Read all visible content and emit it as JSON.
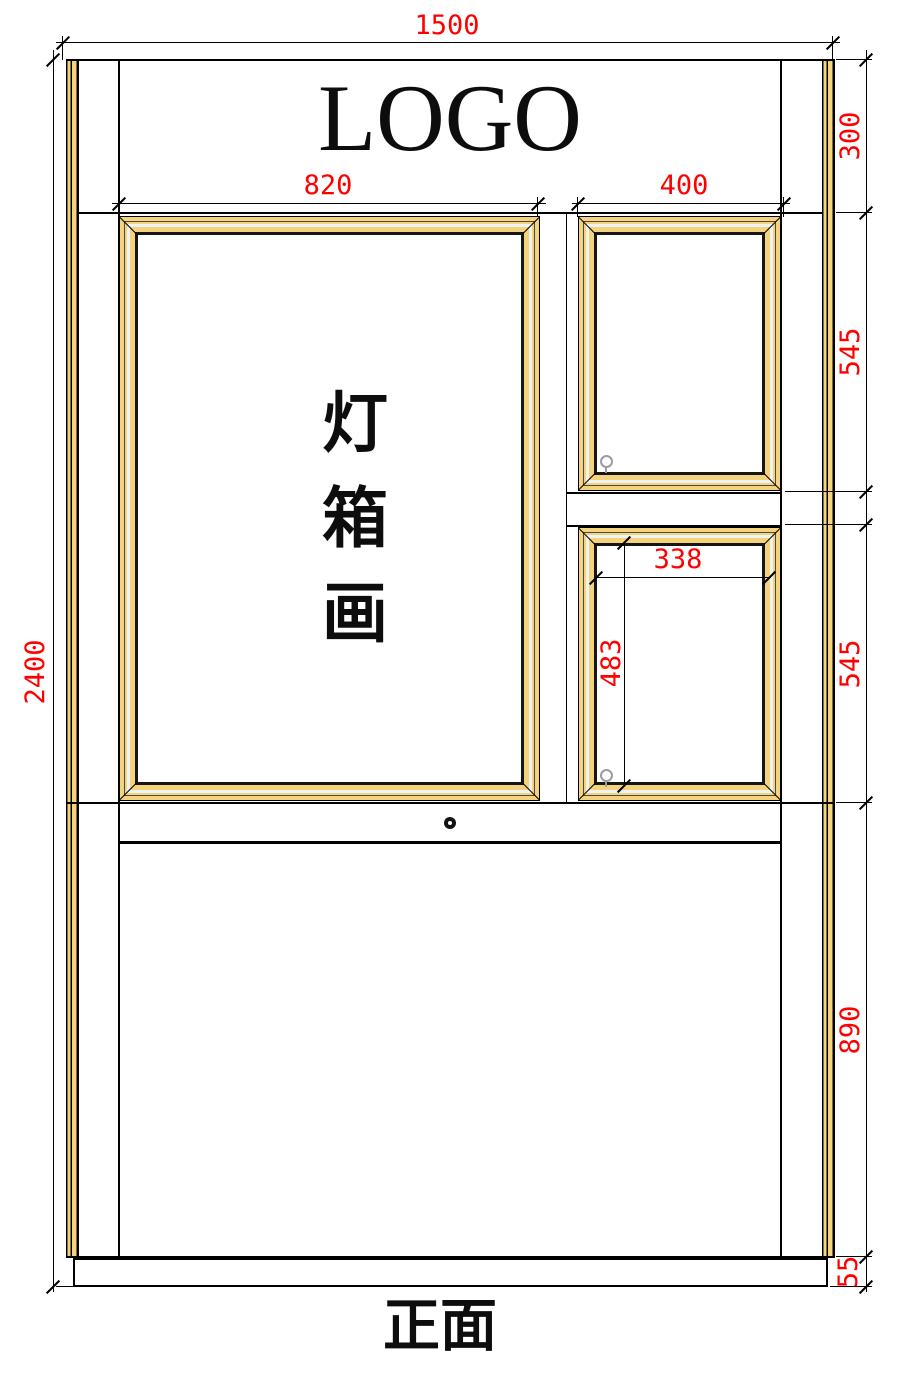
{
  "drawing": {
    "logo_text": "LOGO",
    "lightbox_text": "灯箱画",
    "lightbox_chars": {
      "c0": "灯",
      "c1": "箱",
      "c2": "画"
    },
    "view_label": "正面"
  },
  "dims": {
    "total_width": "1500",
    "total_height": "2400",
    "header_height": "300",
    "lightbox_width": "820",
    "side_frame_width": "400",
    "side_frame_upper_height": "545",
    "side_frame_lower_height": "545",
    "opening_width": "338",
    "opening_height": "483",
    "lower_panel_height": "890",
    "base_height": "55"
  },
  "colors": {
    "dimension_red": "#FF0000",
    "frame_yellow": "#F5D37D",
    "frame_highlight": "#EDF2F3",
    "outline_black": "#000000",
    "pin_gray": "#9C9C9C"
  }
}
